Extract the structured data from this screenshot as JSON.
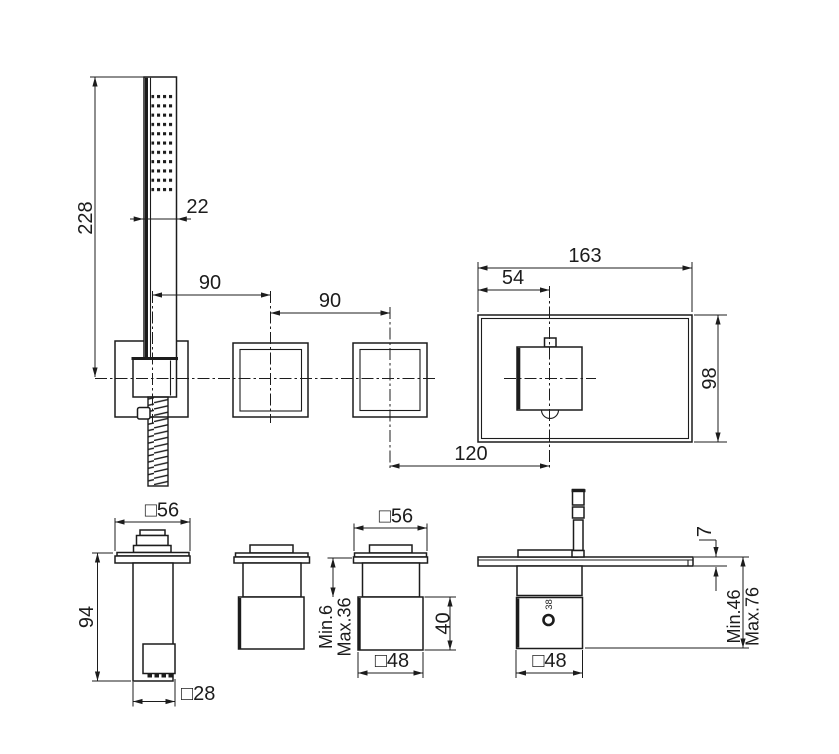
{
  "labels": {
    "handshower_height": "228",
    "handshower_width": "22",
    "holder_to_valve_spacing": "90",
    "valve_to_valve_spacing": "90",
    "plate_width": "163",
    "plate_handle_offset": "54",
    "plate_height": "98",
    "valve_to_handle_spacing": "120",
    "holder_flange_size": "□56",
    "holder_height": "94",
    "holder_outlet_size": "□28",
    "valve_flange_size": "□56",
    "valve_depth_min": "Min.6",
    "valve_depth_max": "Max.36",
    "valve_body_height": "40",
    "valve_body_size": "□48",
    "spout_thickness": "7",
    "spout_depth_min": "Min.46",
    "spout_depth_max": "Max.76",
    "spout_body_size": "□48",
    "temperature_marking": "38"
  },
  "colors": {
    "line": "#1c1c1c",
    "background": "#ffffff"
  }
}
